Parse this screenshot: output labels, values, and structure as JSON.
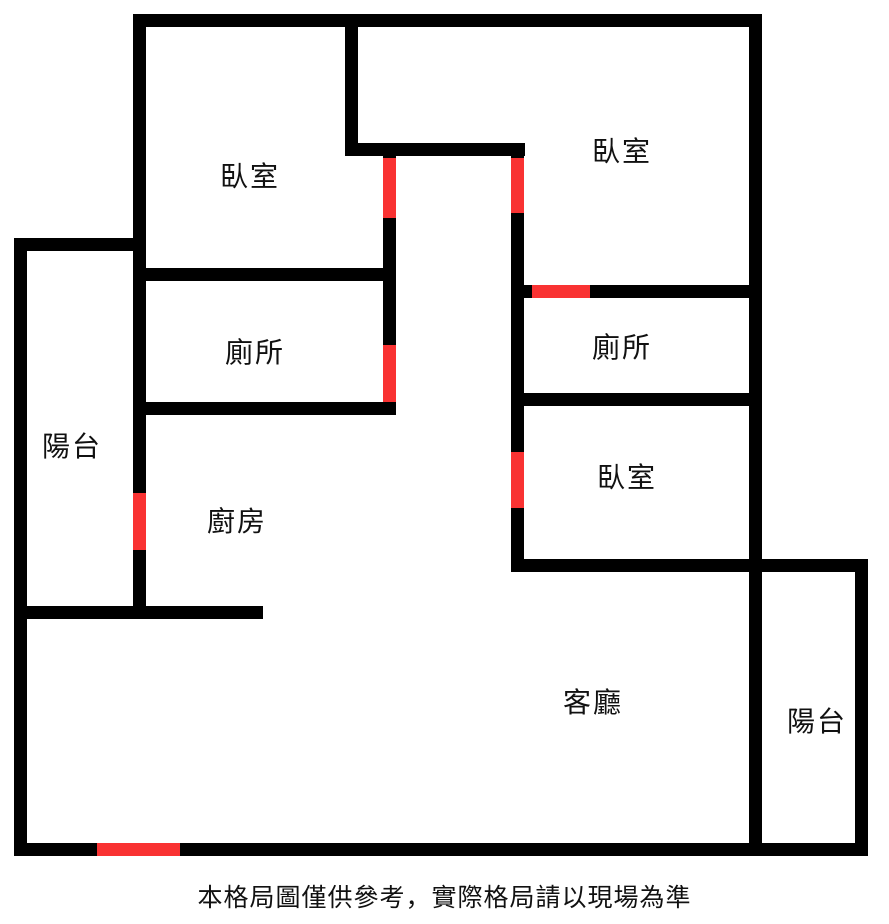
{
  "page": {
    "width": 889,
    "height": 924,
    "background": "#ffffff"
  },
  "colors": {
    "wall": "#000000",
    "door": "#f93232",
    "text": "#111111"
  },
  "floorplan": {
    "walls": [
      {
        "name": "outer-top",
        "x": 133,
        "y": 14,
        "w": 629,
        "h": 13
      },
      {
        "name": "outer-right",
        "x": 749,
        "y": 14,
        "w": 13,
        "h": 842
      },
      {
        "name": "outer-bottom",
        "x": 14,
        "y": 843,
        "w": 854,
        "h": 13
      },
      {
        "name": "outer-left",
        "x": 14,
        "y": 238,
        "w": 13,
        "h": 618
      },
      {
        "name": "balcony-left-top",
        "x": 14,
        "y": 238,
        "w": 119,
        "h": 13
      },
      {
        "name": "west-vertical-divider",
        "x": 133,
        "y": 14,
        "w": 13,
        "h": 605
      },
      {
        "name": "bedroom-topleft-right-upper",
        "x": 345,
        "y": 14,
        "w": 13,
        "h": 141
      },
      {
        "name": "hallway-top-jog",
        "x": 345,
        "y": 143,
        "w": 180,
        "h": 13
      },
      {
        "name": "hallway-left-vertical",
        "x": 383,
        "y": 155,
        "w": 13,
        "h": 260
      },
      {
        "name": "bedroom-topleft-bottom",
        "x": 133,
        "y": 268,
        "w": 263,
        "h": 13
      },
      {
        "name": "toilet-left-bottom",
        "x": 133,
        "y": 402,
        "w": 263,
        "h": 13
      },
      {
        "name": "kitchen-bottom",
        "x": 15,
        "y": 606,
        "w": 248,
        "h": 13
      },
      {
        "name": "hallway-right-vertical",
        "x": 511,
        "y": 143,
        "w": 13,
        "h": 429
      },
      {
        "name": "toilet-right-top",
        "x": 511,
        "y": 285,
        "w": 251,
        "h": 13
      },
      {
        "name": "toilet-right-bottom",
        "x": 511,
        "y": 393,
        "w": 251,
        "h": 13
      },
      {
        "name": "bedroom-right-bottom-balcony-top",
        "x": 511,
        "y": 559,
        "w": 357,
        "h": 13
      },
      {
        "name": "balcony-right-outer",
        "x": 855,
        "y": 559,
        "w": 13,
        "h": 297
      }
    ],
    "doors": [
      {
        "name": "bedroom-topleft-door",
        "x": 383,
        "y": 158,
        "w": 13,
        "h": 60
      },
      {
        "name": "bedroom-topright-door",
        "x": 511,
        "y": 158,
        "w": 13,
        "h": 55
      },
      {
        "name": "toilet-right-door",
        "x": 532,
        "y": 285,
        "w": 58,
        "h": 13
      },
      {
        "name": "toilet-left-door",
        "x": 383,
        "y": 345,
        "w": 13,
        "h": 57
      },
      {
        "name": "bedroom-right-door",
        "x": 511,
        "y": 452,
        "w": 13,
        "h": 56
      },
      {
        "name": "balcony-left-door",
        "x": 133,
        "y": 493,
        "w": 13,
        "h": 57
      },
      {
        "name": "main-entrance-door",
        "x": 97,
        "y": 843,
        "w": 83,
        "h": 13
      }
    ],
    "rooms": [
      {
        "name": "bedroom-top-left",
        "label": "臥室",
        "x": 250,
        "y": 177
      },
      {
        "name": "bedroom-top-right",
        "label": "臥室",
        "x": 622,
        "y": 152
      },
      {
        "name": "toilet-left",
        "label": "廁所",
        "x": 255,
        "y": 353
      },
      {
        "name": "toilet-right",
        "label": "廁所",
        "x": 622,
        "y": 348
      },
      {
        "name": "balcony-left",
        "label": "陽台",
        "x": 72,
        "y": 447
      },
      {
        "name": "kitchen",
        "label": "廚房",
        "x": 237,
        "y": 522
      },
      {
        "name": "bedroom-right",
        "label": "臥室",
        "x": 627,
        "y": 478
      },
      {
        "name": "living-room",
        "label": "客廳",
        "x": 593,
        "y": 703
      },
      {
        "name": "balcony-right",
        "label": "陽台",
        "x": 817,
        "y": 722
      }
    ]
  },
  "footer": {
    "disclaimer": "本格局圖僅供參考，實際格局請以現場為準"
  }
}
